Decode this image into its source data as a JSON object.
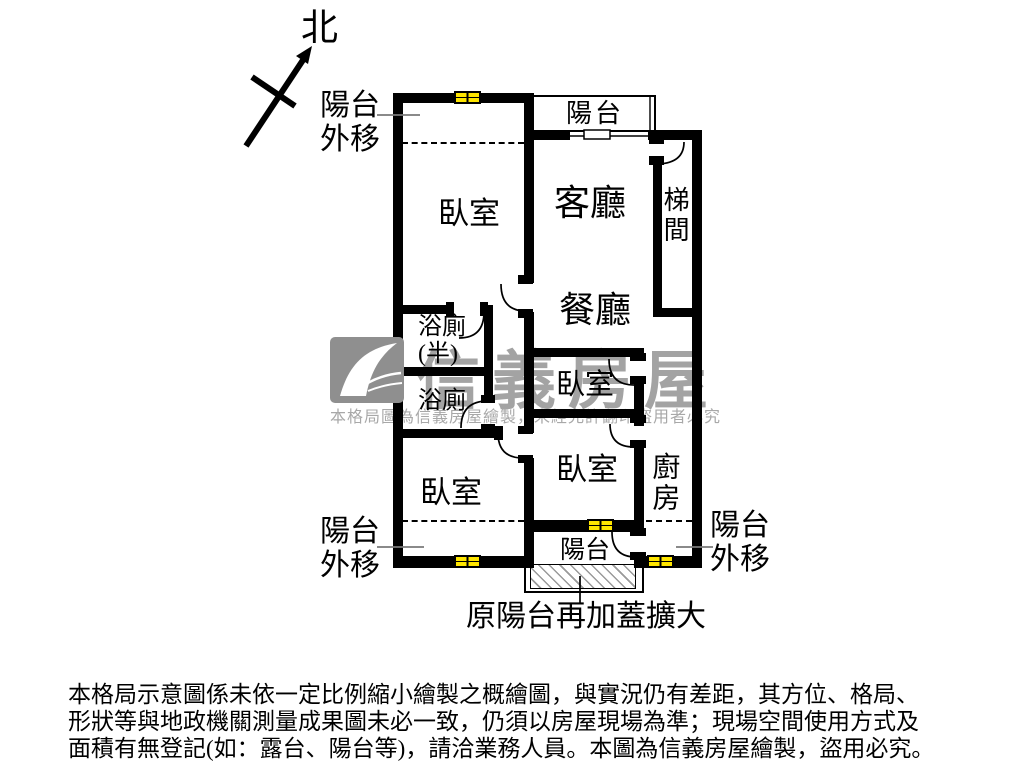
{
  "colors": {
    "wall": "#000000",
    "window_fill": "#ffe600",
    "watermark_gray": "#a3a3a3",
    "logo_gray": "#8f8f8f",
    "background": "#ffffff"
  },
  "compass": {
    "north_label": "北"
  },
  "plan": {
    "rooms": {
      "bedroom_top": "臥室",
      "living": "客廳",
      "stairwell": "梯間",
      "dining": "餐廳",
      "bath_half": "浴廁\n(半)",
      "bath": "浴廁",
      "bedroom_mid": "臥室",
      "bedroom_lower": "臥室",
      "bedroom_bottom_left": "臥室",
      "kitchen": "廚房",
      "balcony_top": "陽台",
      "balcony_bottom": "陽台"
    },
    "annotations": {
      "balcony_out_top_left": "陽台\n外移",
      "balcony_out_bottom_left": "陽台\n外移",
      "balcony_out_bottom_right": "陽台\n外移",
      "balcony_expanded": "原陽台再加蓋擴大"
    },
    "watermark": {
      "brand": "信義房屋",
      "notice": "本格局圖為信義房屋繪製，未經允許翻印盜用者必究"
    }
  },
  "disclaimer": {
    "line1": "本格局示意圖係未依一定比例縮小繪製之概繪圖，與實況仍有差距，其方位、格局、",
    "line2": "形狀等與地政機關測量成果圖未必一致，仍須以房屋現場為準；現場空間使用方式及",
    "line3": "面積有無登記(如：露台、陽台等)，請洽業務人員。本圖為信義房屋繪製，盜用必究。"
  },
  "icons": {
    "north_arrow": "north-arrow",
    "sinyi_logo": "gray square with white swoosh",
    "window": "yellow 4-pane window symbol",
    "door_arc": "quarter-circle door swing",
    "sliding_door": "sliding window symbol"
  }
}
